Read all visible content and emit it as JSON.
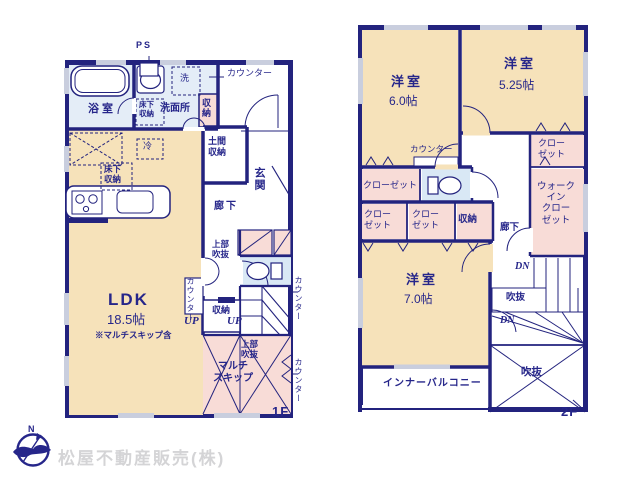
{
  "colors": {
    "wall": "#23237e",
    "room_tan": "#f6e2ba",
    "room_pink": "#f8dcd7",
    "room_blue": "#e4edf7",
    "toilet_blue": "#d9e8f5",
    "window_gray": "#c9cede",
    "text_navy": "#26268a",
    "watermark_gray": "#d4d4d6"
  },
  "footer": {
    "company": "松屋不動産販売(株)",
    "compass_n": "N"
  },
  "floor1": {
    "floor_label": "1F",
    "labels": {
      "ps": "PS",
      "counter_top": "カウンター",
      "bath": "浴室",
      "washroom": "洗面所",
      "laundry": "洗",
      "underfloor_storage_a": "床下\n収納",
      "storage_hall": "収納",
      "doma_storage": "土間\n収納",
      "entrance": "玄関",
      "fridge": "冷",
      "underfloor_storage_b": "床下\n収納",
      "hallway": "廊下",
      "upper_void_a": "上部\n吹抜",
      "counter_right_a": "カウンター",
      "ldk_name": "LDK",
      "ldk_size": "18.5帖",
      "ldk_note": "※マルチスキップ含",
      "counter_mid": "カウンター",
      "up_a": "UP",
      "stair_storage": "収納",
      "up_b": "UP",
      "upper_void_b": "上部\n吹抜",
      "multi_skip": "マルチ\nスキップ",
      "counter_right_b": "カウンター"
    }
  },
  "floor2": {
    "floor_label": "2F",
    "labels": {
      "bedroom1_name": "洋室",
      "bedroom1_size": "6.0帖",
      "bedroom2_name": "洋室",
      "bedroom2_size": "5.25帖",
      "counter": "カウンター",
      "closet_a": "クロー\nゼット",
      "closet_wide": "クローゼット",
      "closet_b": "クロー\nゼット",
      "closet_c": "クロー\nゼット",
      "storage": "収納",
      "wic": "ウォーク\nイン\nクロー\nゼット",
      "hallway": "廊下",
      "dn_a": "DN",
      "void_small": "吹抜",
      "dn_b": "DN",
      "bedroom3_name": "洋室",
      "bedroom3_size": "7.0帖",
      "void_large": "吹抜",
      "inner_balcony": "インナーバルコニー"
    }
  }
}
